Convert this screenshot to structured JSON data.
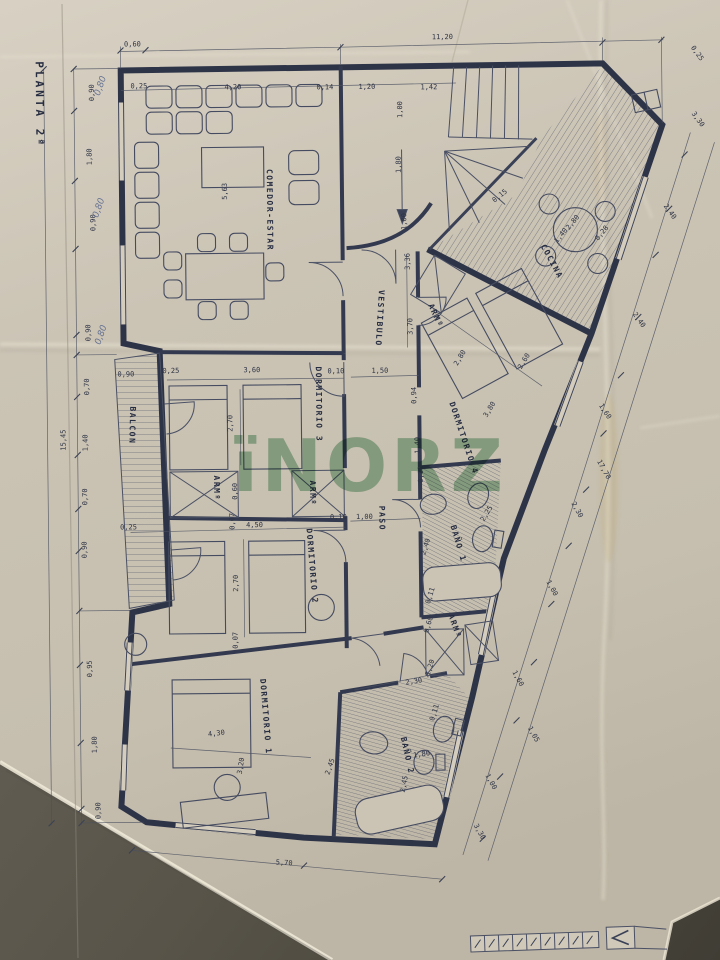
{
  "meta": {
    "sheet_title": "PLANTA 2ª",
    "watermark": "ïNORZ",
    "paper_color": "#cbc4b5",
    "ink_color": "#2e3448",
    "watermark_color": "#4f9663",
    "background_color": "#55514a"
  },
  "plan": {
    "room_labels": [
      {
        "t": "PLANTA 2ª",
        "x": 40,
        "y": 58,
        "r": 90,
        "s": 11,
        "sp": 3,
        "n": "plan-title"
      },
      {
        "t": "COMEDOR-ESTAR",
        "x": 270,
        "y": 168,
        "r": 90,
        "n": "room-label-comedor-estar"
      },
      {
        "t": "COCINA",
        "x": 543,
        "y": 248,
        "r": 62,
        "n": "room-label-cocina"
      },
      {
        "t": "VESTIBULO",
        "x": 381,
        "y": 290,
        "r": 94,
        "n": "room-label-vestibulo"
      },
      {
        "t": "BALCON",
        "x": 131,
        "y": 404,
        "r": 92,
        "n": "room-label-balcon"
      },
      {
        "t": "DORMITORIO 3",
        "x": 317,
        "y": 366,
        "r": 90,
        "n": "room-label-dormitorio-3"
      },
      {
        "t": "DORMITORIO 4",
        "x": 450,
        "y": 404,
        "r": 72,
        "n": "room-label-dormitorio-4"
      },
      {
        "t": "DORMITORIO 2",
        "x": 306,
        "y": 528,
        "r": 86,
        "n": "room-label-dormitorio-2"
      },
      {
        "t": "DORMITORIO 1",
        "x": 258,
        "y": 678,
        "r": 86,
        "n": "room-label-dormitorio-1"
      },
      {
        "t": "BAÑO 1",
        "x": 450,
        "y": 527,
        "r": 74,
        "n": "room-label-bano-1"
      },
      {
        "t": "BAÑO 2",
        "x": 398,
        "y": 738,
        "r": 78,
        "n": "room-label-bano-2"
      },
      {
        "t": "PASO",
        "x": 379,
        "y": 506,
        "r": 90,
        "n": "room-label-paso"
      },
      {
        "t": "ARMº",
        "x": 214,
        "y": 474,
        "r": 90,
        "n": "closet-label-1"
      },
      {
        "t": "ARMº",
        "x": 310,
        "y": 480,
        "r": 90,
        "n": "closet-label-2"
      },
      {
        "t": "ARMº",
        "x": 430,
        "y": 306,
        "r": 66,
        "n": "closet-label-3"
      },
      {
        "t": "ARMº",
        "x": 447,
        "y": 616,
        "r": 72,
        "n": "closet-label-4"
      }
    ],
    "dimensions": [
      {
        "t": "0,60",
        "x": 137,
        "y": 44
      },
      {
        "t": "11,20",
        "x": 447,
        "y": 40
      },
      {
        "t": "0,25",
        "x": 143,
        "y": 86
      },
      {
        "t": "4,20",
        "x": 237,
        "y": 88
      },
      {
        "t": "0,14",
        "x": 329,
        "y": 89
      },
      {
        "t": "1,20",
        "x": 371,
        "y": 89
      },
      {
        "t": "1,42",
        "x": 433,
        "y": 90
      },
      {
        "t": "1,00",
        "x": 406,
        "y": 110,
        "r": -90
      },
      {
        "t": "1,80",
        "x": 404,
        "y": 165,
        "r": -90
      },
      {
        "t": "1,00",
        "x": 409,
        "y": 222,
        "r": -90
      },
      {
        "t": "3,36",
        "x": 412,
        "y": 262,
        "r": -90
      },
      {
        "t": "0,15",
        "x": 504,
        "y": 199,
        "r": -38
      },
      {
        "t": "2,80",
        "x": 577,
        "y": 226,
        "r": -50
      },
      {
        "t": "1,40",
        "x": 565,
        "y": 239,
        "r": -50
      },
      {
        "t": "0,28",
        "x": 606,
        "y": 237,
        "r": -50
      },
      {
        "t": "0,90",
        "x": 98,
        "y": 90,
        "r": -90
      },
      {
        "t": "1,80",
        "x": 95,
        "y": 154,
        "r": -90
      },
      {
        "t": "0,90",
        "x": 98,
        "y": 220,
        "r": -90
      },
      {
        "t": "0,90",
        "x": 92,
        "y": 330,
        "r": -90
      },
      {
        "t": "0,70",
        "x": 90,
        "y": 384,
        "r": -90
      },
      {
        "t": "1,40",
        "x": 88,
        "y": 440,
        "r": -90
      },
      {
        "t": "0,70",
        "x": 87,
        "y": 494,
        "r": -90
      },
      {
        "t": "0,90",
        "x": 86,
        "y": 547,
        "r": -90
      },
      {
        "t": "0,95",
        "x": 90,
        "y": 666,
        "r": -90
      },
      {
        "t": "1,80",
        "x": 94,
        "y": 742,
        "r": -90
      },
      {
        "t": "0,90",
        "x": 97,
        "y": 808,
        "r": -90
      },
      {
        "t": "15,45",
        "x": 66,
        "y": 437,
        "r": -90
      },
      {
        "t": "5,63",
        "x": 230,
        "y": 190,
        "r": -90
      },
      {
        "t": "0,90",
        "x": 127,
        "y": 374
      },
      {
        "t": "0,25",
        "x": 172,
        "y": 371
      },
      {
        "t": "3,60",
        "x": 253,
        "y": 371
      },
      {
        "t": "2,70",
        "x": 233,
        "y": 422,
        "r": -90
      },
      {
        "t": "0,10",
        "x": 337,
        "y": 373
      },
      {
        "t": "1,50",
        "x": 381,
        "y": 373
      },
      {
        "t": "3,70",
        "x": 414,
        "y": 327,
        "r": -90
      },
      {
        "t": "0,94",
        "x": 417,
        "y": 396,
        "r": -90
      },
      {
        "t": "2,80",
        "x": 463,
        "y": 360,
        "r": -58
      },
      {
        "t": "2,60",
        "x": 527,
        "y": 364,
        "r": -58
      },
      {
        "t": "3,80",
        "x": 492,
        "y": 412,
        "r": -58
      },
      {
        "t": "1,60",
        "x": 604,
        "y": 415,
        "r": 58
      },
      {
        "t": "1,40",
        "x": 420,
        "y": 446,
        "r": -90
      },
      {
        "t": "0,11",
        "x": 423,
        "y": 475,
        "r": -90
      },
      {
        "t": "0,10",
        "x": 338,
        "y": 519
      },
      {
        "t": "1,00",
        "x": 364,
        "y": 519
      },
      {
        "t": "0,60",
        "x": 237,
        "y": 490,
        "r": -90
      },
      {
        "t": "0,07",
        "x": 234,
        "y": 520,
        "r": -90
      },
      {
        "t": "4,50",
        "x": 254,
        "y": 526
      },
      {
        "t": "2,70",
        "x": 237,
        "y": 582,
        "r": -90
      },
      {
        "t": "0,07",
        "x": 236,
        "y": 639,
        "r": -90
      },
      {
        "t": "0,25",
        "x": 128,
        "y": 527
      },
      {
        "t": "2,25",
        "x": 488,
        "y": 516,
        "r": -58
      },
      {
        "t": "2,40",
        "x": 427,
        "y": 548,
        "r": -72
      },
      {
        "t": "0,11",
        "x": 431,
        "y": 597,
        "r": -72
      },
      {
        "t": "0,60",
        "x": 429,
        "y": 626,
        "r": -72
      },
      {
        "t": "0,25",
        "x": 700,
        "y": 58,
        "r": 55
      },
      {
        "t": "3,30",
        "x": 700,
        "y": 124,
        "r": 55
      },
      {
        "t": "2,40",
        "x": 671,
        "y": 216,
        "r": 55
      },
      {
        "t": "2,40",
        "x": 639,
        "y": 324,
        "r": 55
      },
      {
        "t": "17,70",
        "x": 602,
        "y": 473,
        "r": 62
      },
      {
        "t": "2,30",
        "x": 575,
        "y": 513,
        "r": 62
      },
      {
        "t": "1,00",
        "x": 549,
        "y": 591,
        "r": 62
      },
      {
        "t": "1,60",
        "x": 514,
        "y": 681,
        "r": 62
      },
      {
        "t": "1,05",
        "x": 529,
        "y": 737,
        "r": 62
      },
      {
        "t": "1,00",
        "x": 486,
        "y": 784,
        "r": 62
      },
      {
        "t": "3,30",
        "x": 474,
        "y": 834,
        "r": 62
      },
      {
        "t": "1,20",
        "x": 430,
        "y": 669,
        "r": -72
      },
      {
        "t": "2,30",
        "x": 412,
        "y": 684,
        "r": -8
      },
      {
        "t": "0,11",
        "x": 434,
        "y": 714,
        "r": -72
      },
      {
        "t": "1,80",
        "x": 419,
        "y": 757,
        "r": -8
      },
      {
        "t": "2,45",
        "x": 403,
        "y": 785,
        "r": -78
      },
      {
        "t": "4,30",
        "x": 214,
        "y": 734,
        "r": -6
      },
      {
        "t": "3,20",
        "x": 240,
        "y": 765,
        "r": -80
      },
      {
        "t": "2,45",
        "x": 329,
        "y": 767,
        "r": -70
      },
      {
        "t": "5,70",
        "x": 280,
        "y": 864,
        "r": 4
      }
    ],
    "handwritten_notes": [
      {
        "t": "0,80",
        "x": 107,
        "y": 84,
        "r": -70,
        "n": "pencil-note-1"
      },
      {
        "t": "0,80",
        "x": 104,
        "y": 206,
        "r": -70,
        "n": "pencil-note-2"
      },
      {
        "t": "0,80",
        "x": 105,
        "y": 333,
        "r": -70,
        "n": "pencil-note-3"
      }
    ]
  }
}
